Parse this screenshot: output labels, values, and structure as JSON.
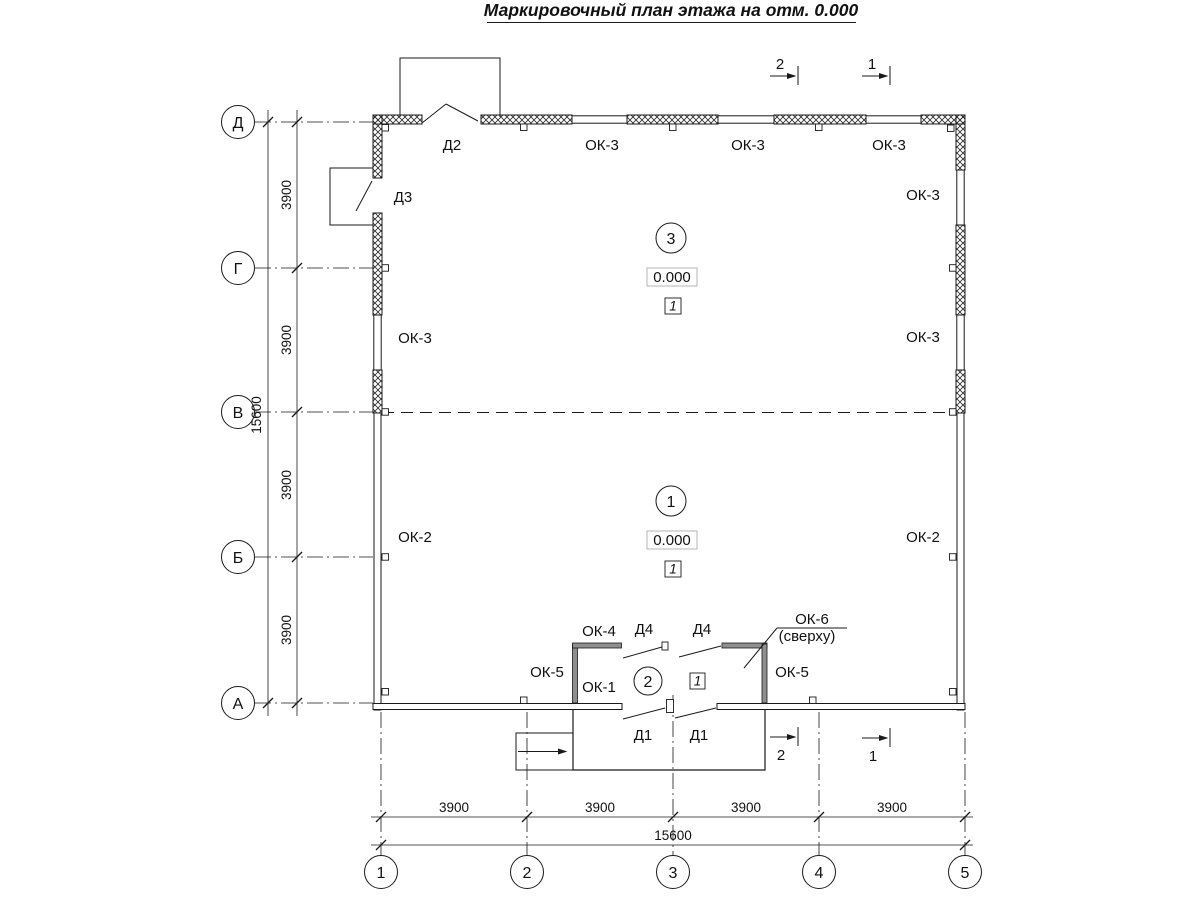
{
  "title": "Маркировочный план этажа на отм. 0.000",
  "axis_rows": [
    "Д",
    "Г",
    "В",
    "Б",
    "А"
  ],
  "axis_cols": [
    "1",
    "2",
    "3",
    "4",
    "5"
  ],
  "dims": {
    "seg": "3900",
    "total": "15600"
  },
  "sections": {
    "s1": "1",
    "s2": "2"
  },
  "room_numbers": {
    "upper": "3",
    "lower": "1",
    "vestibule": "2"
  },
  "level": "0.000",
  "floor_type": "1",
  "marks": {
    "ok1": "ОК-1",
    "ok2": "ОК-2",
    "ok3": "ОК-3",
    "ok4": "ОК-4",
    "ok5": "ОК-5",
    "ok6": "ОК-6",
    "ok6_note": "(сверху)",
    "d1": "Д1",
    "d2": "Д2",
    "d3": "Д3",
    "d4": "Д4"
  }
}
